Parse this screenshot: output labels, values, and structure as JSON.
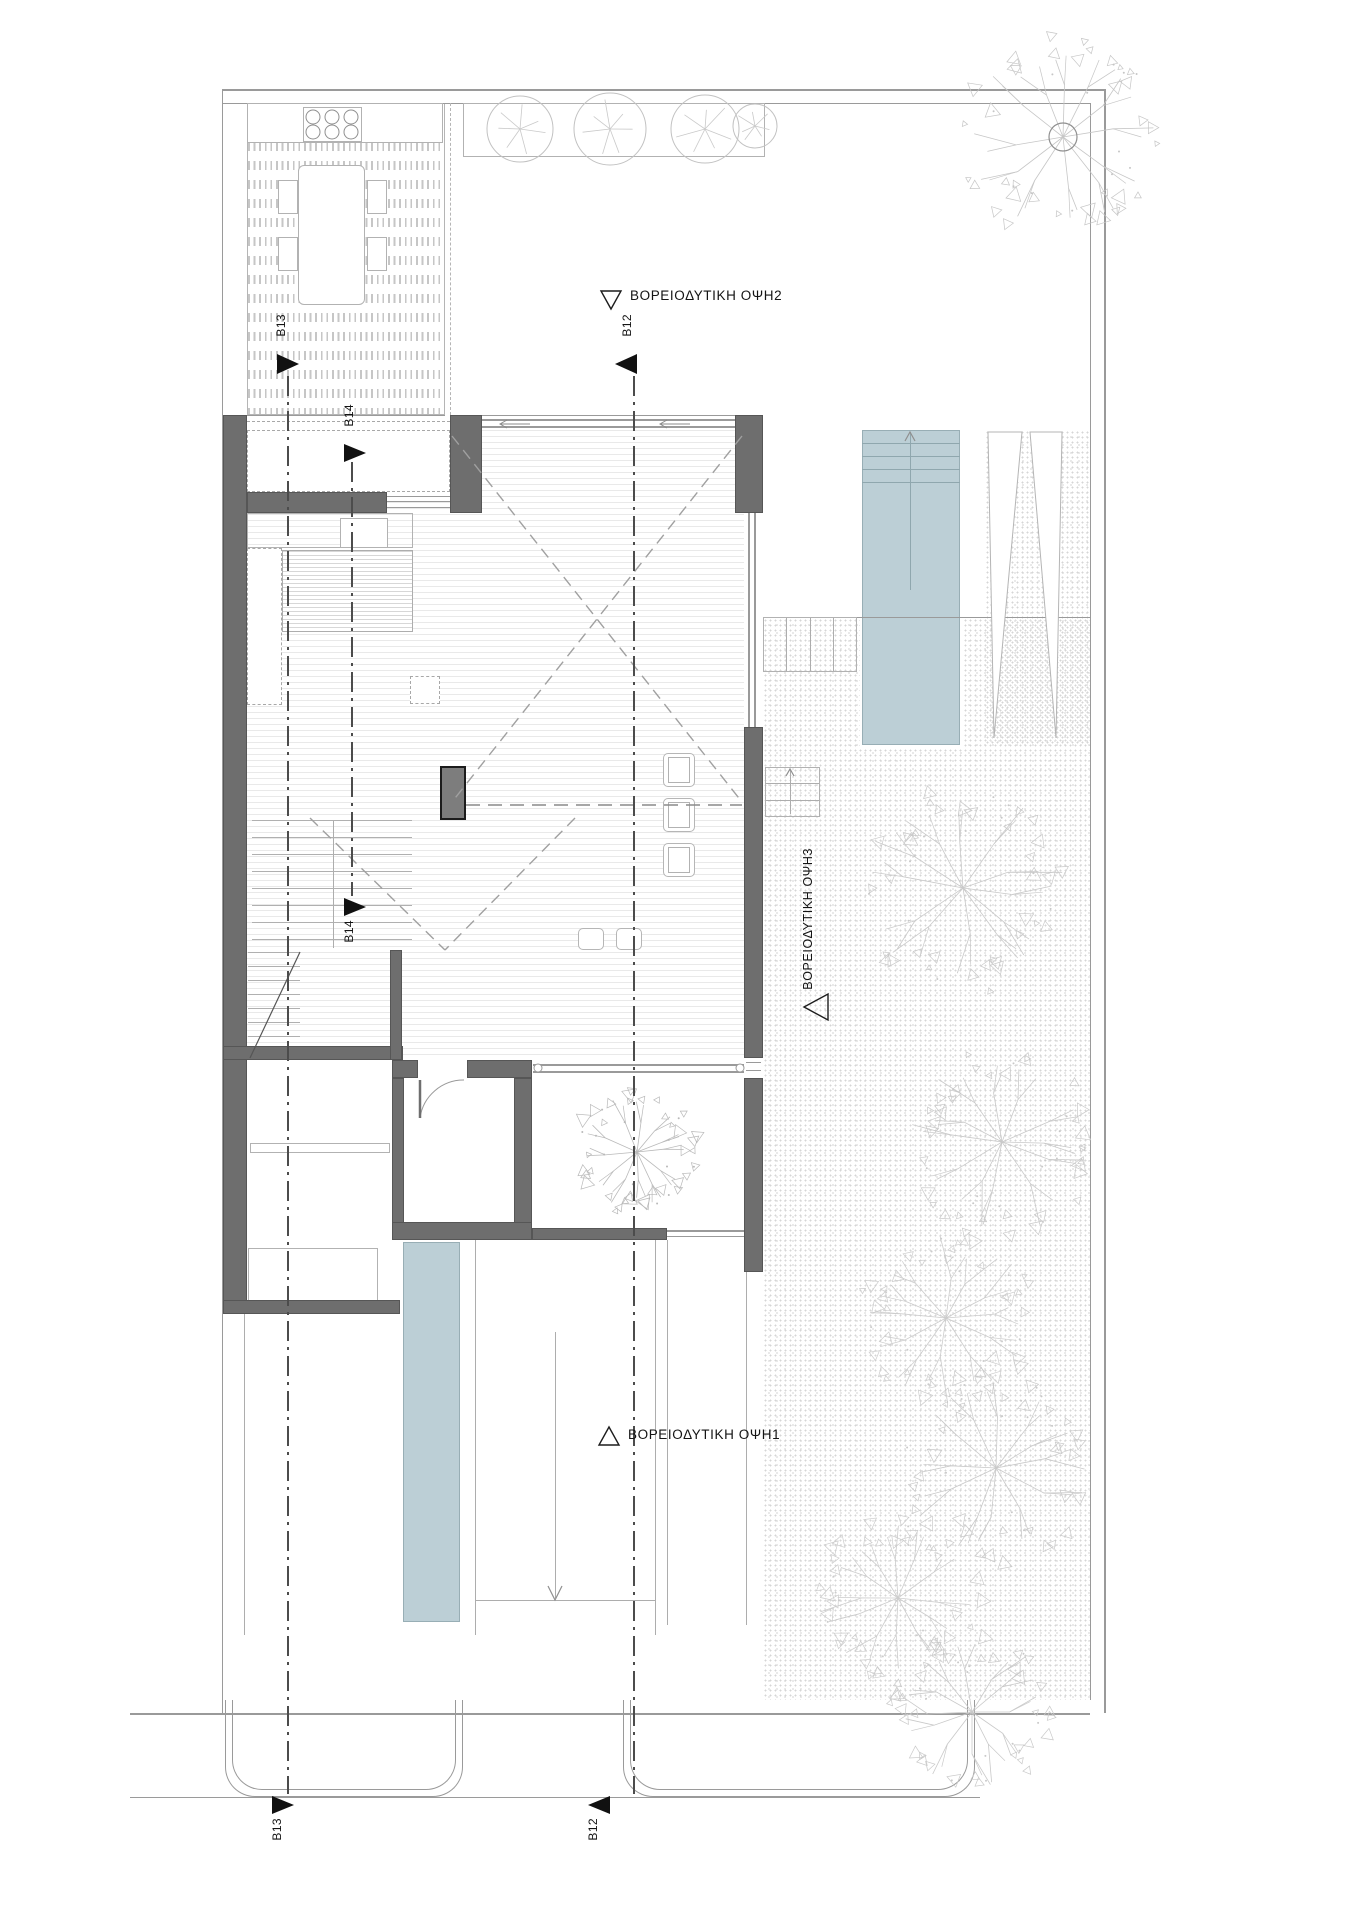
{
  "title": "Architectural ground floor site plan",
  "labels": {
    "elevation_top": "ΒΟΡΕΙΟΔΥΤΙΚΗ ΟΨΗ2",
    "elevation_bottom": "ΒΟΡΕΙΟΔΥΤΙΚΗ ΟΨΗ1",
    "elevation_right": "ΒΟΡΕΙΟΔΥΤΙΚΗ ΟΨΗ3",
    "section_b12": "B12",
    "section_b13": "B13",
    "section_b14": "B14"
  },
  "colors": {
    "wall": "#6e6e6e",
    "water": "#bccfd6",
    "line_light": "#b5b5b5",
    "line_mid": "#9a9a9a",
    "tree": "#c8c8c8",
    "marker": "#111111",
    "text": "#141414",
    "floor_line": "#e9e9e9",
    "gravel_dot": "#d6d6d6"
  },
  "scene": {
    "boundary_lines": [
      [
        222,
        89,
        883,
        2
      ],
      [
        222,
        103,
        868,
        1
      ],
      [
        1104,
        89,
        2,
        1624
      ],
      [
        1090,
        103,
        1,
        1597
      ],
      [
        222,
        89,
        1,
        1624
      ],
      [
        130,
        1713,
        960,
        2
      ],
      [
        130,
        1797,
        850,
        1
      ],
      [
        450,
        415,
        313,
        1
      ],
      [
        763,
        617,
        327,
        1
      ]
    ],
    "gravel_regions": [
      [
        763,
        618,
        327,
        1082
      ],
      [
        985,
        430,
        105,
        315
      ]
    ],
    "floor_region": [
      247,
      430,
      497,
      628
    ],
    "deck_region": [
      247,
      103,
      198,
      312
    ],
    "walls": [
      [
        223,
        415,
        24,
        887
      ],
      [
        247,
        492,
        140,
        21
      ],
      [
        450,
        415,
        32,
        98
      ],
      [
        735,
        415,
        28,
        98
      ],
      [
        744,
        727,
        19,
        331
      ],
      [
        744,
        1078,
        19,
        194
      ],
      [
        223,
        1046,
        180,
        14
      ],
      [
        392,
        1060,
        26,
        18
      ],
      [
        467,
        1060,
        65,
        18
      ],
      [
        392,
        1078,
        12,
        162
      ],
      [
        514,
        1078,
        18,
        145
      ],
      [
        392,
        1222,
        140,
        18
      ],
      [
        532,
        1228,
        135,
        12
      ],
      [
        223,
        1300,
        177,
        14
      ],
      [
        390,
        950,
        12,
        110
      ]
    ],
    "fireplace": [
      440,
      766,
      26,
      54
    ],
    "white_fills": [
      [
        404,
        1078,
        110,
        144
      ],
      [
        533,
        1075,
        211,
        153
      ],
      [
        247,
        1060,
        143,
        240
      ],
      [
        860,
        428,
        102,
        319
      ]
    ],
    "boxes": [
      {
        "r": [
          247,
          103,
          196,
          40
        ],
        "n": "outdoor-counter"
      },
      {
        "r": [
          303,
          107,
          59,
          35
        ],
        "n": "bbq-grill"
      },
      {
        "r": [
          463,
          103,
          302,
          54
        ],
        "n": "planter"
      },
      {
        "r": [
          298,
          165,
          67,
          140
        ],
        "n": "outdoor-table",
        "rad": 6
      },
      {
        "r": [
          278,
          180,
          20,
          34
        ],
        "n": "outdoor-chair"
      },
      {
        "r": [
          278,
          237,
          20,
          34
        ],
        "n": "outdoor-chair"
      },
      {
        "r": [
          367,
          180,
          20,
          34
        ],
        "n": "outdoor-chair"
      },
      {
        "r": [
          367,
          237,
          20,
          34
        ],
        "n": "outdoor-chair"
      },
      {
        "r": [
          247,
          513,
          166,
          35
        ],
        "n": "kitchen-counter",
        "nofill": true
      },
      {
        "r": [
          340,
          518,
          48,
          30
        ],
        "n": "cooktop"
      },
      {
        "r": [
          343,
          562,
          40,
          35
        ],
        "n": "sink"
      },
      {
        "r": [
          349,
          568,
          28,
          23
        ],
        "n": "sink-basin"
      },
      {
        "r": [
          250,
          1143,
          140,
          10
        ],
        "n": "shelf"
      },
      {
        "r": [
          248,
          1248,
          130,
          53
        ],
        "n": "cabinets"
      },
      {
        "r": [
          763,
          617,
          94,
          55
        ],
        "n": "garden-steps",
        "nofill": true
      },
      {
        "r": [
          765,
          767,
          55,
          50
        ],
        "n": "terrace-steps",
        "nofill": true
      }
    ],
    "dashed_boxes": [
      {
        "r": [
          247,
          430,
          203,
          62
        ],
        "n": "vestibule"
      },
      {
        "r": [
          247,
          548,
          35,
          157
        ],
        "n": "kitchen-cabinets-left"
      },
      {
        "r": [
          410,
          676,
          30,
          28
        ],
        "n": "island-appliance"
      }
    ],
    "island": [
      282,
      550,
      131,
      82
    ],
    "chairs": [
      [
        663,
        753,
        32,
        34
      ],
      [
        663,
        798,
        32,
        34
      ],
      [
        663,
        843,
        32,
        34
      ]
    ],
    "stools": [
      [
        578,
        928,
        26,
        22
      ],
      [
        616,
        928,
        26,
        22
      ]
    ],
    "glass_lines": [
      [
        482,
        419,
        253,
        2
      ],
      [
        482,
        426,
        253,
        2
      ],
      [
        748,
        513,
        2,
        214
      ],
      [
        754,
        513,
        2,
        214
      ],
      [
        533,
        1064,
        211,
        2
      ],
      [
        533,
        1071,
        211,
        2
      ],
      [
        667,
        1230,
        77,
        2
      ],
      [
        667,
        1236,
        77,
        1
      ],
      [
        247,
        415,
        198,
        1
      ],
      [
        387,
        496,
        63,
        1
      ],
      [
        387,
        501,
        63,
        1
      ],
      [
        387,
        507,
        63,
        1
      ],
      [
        746,
        1062,
        15,
        1
      ],
      [
        746,
        1070,
        15,
        1
      ]
    ],
    "detail_lines": [
      [
        475,
        1240,
        1,
        395
      ],
      [
        655,
        1240,
        1,
        395
      ],
      [
        667,
        1240,
        1,
        385
      ],
      [
        746,
        1272,
        1,
        353
      ],
      [
        475,
        1600,
        180,
        1
      ],
      [
        244,
        1314,
        1,
        321
      ],
      [
        786,
        617,
        1,
        55
      ],
      [
        810,
        617,
        1,
        55
      ],
      [
        833,
        617,
        1,
        55
      ],
      [
        765,
        783,
        55,
        1
      ],
      [
        765,
        800,
        55,
        1
      ],
      [
        248,
        1274,
        130,
        1
      ],
      [
        281,
        1248,
        1,
        53
      ],
      [
        314,
        1248,
        1,
        53
      ],
      [
        347,
        1248,
        1,
        53
      ],
      [
        333,
        820,
        1,
        128
      ],
      [
        555,
        1332,
        1,
        266
      ],
      [
        790,
        770,
        1,
        44
      ]
    ],
    "stairs": {
      "lower": {
        "x": 252,
        "w": 160,
        "y0": 820,
        "step": 17,
        "count": 8
      },
      "upper": {
        "x": 248,
        "w": 52,
        "y0": 952,
        "step": 14,
        "count": 8
      }
    },
    "pool": {
      "r": [
        862,
        430,
        98,
        315
      ],
      "steps": [
        443,
        456,
        469,
        482
      ],
      "center_x": 910,
      "line_y": [
        432,
        590
      ]
    },
    "water_channel": [
      403,
      1242,
      57,
      380
    ],
    "ramp_triangles": [
      [
        [
          988,
          432
        ],
        [
          1022,
          432
        ],
        [
          994,
          738
        ]
      ],
      [
        [
          1030,
          432
        ],
        [
          1062,
          432
        ],
        [
          1056,
          738
        ]
      ]
    ],
    "aprons": [
      [
        225,
        1700,
        238,
        97
      ],
      [
        623,
        1700,
        352,
        97
      ]
    ],
    "dashed_diagonals": [
      [
        452,
        436,
        742,
        802
      ],
      [
        742,
        436,
        452,
        802
      ],
      [
        310,
        818,
        445,
        950
      ],
      [
        575,
        818,
        445,
        950
      ]
    ],
    "long_dash_h": [
      466,
      805,
      742
    ],
    "vestibule_dash_line": [
      247,
      421,
      203
    ],
    "deck_edge_dash": [
      450,
      103,
      312
    ],
    "door_arc": {
      "hinge": [
        420,
        1080
      ],
      "leaf_end": [
        420,
        1118
      ],
      "arc_end": [
        464,
        1080
      ]
    },
    "stair_break": [
      [
        250,
        1058
      ],
      [
        300,
        952
      ]
    ],
    "slide_arrows": [
      [
        530,
        424,
        500,
        424
      ],
      [
        690,
        424,
        660,
        424
      ]
    ],
    "pool_arrow": [
      [
        905,
        441
      ],
      [
        910,
        432
      ],
      [
        915,
        441
      ]
    ],
    "walk_arrow": [
      [
        548,
        1586
      ],
      [
        555,
        1600
      ],
      [
        562,
        1586
      ]
    ],
    "steps_arrow": [
      [
        786,
        776
      ],
      [
        790,
        769
      ],
      [
        794,
        776
      ]
    ],
    "glass_end_circles": [
      [
        538,
        1068
      ],
      [
        740,
        1068
      ]
    ],
    "trunk_circle": [
      1063,
      137,
      14
    ],
    "trees": [
      {
        "x": 1063,
        "y": 137,
        "r": 98,
        "c": "#c6c6c6"
      },
      {
        "x": 963,
        "y": 888,
        "r": 102,
        "c": "#c9c9c9"
      },
      {
        "x": 1002,
        "y": 1142,
        "r": 92,
        "c": "#c9c9c9"
      },
      {
        "x": 946,
        "y": 1318,
        "r": 85,
        "c": "#cccccc"
      },
      {
        "x": 996,
        "y": 1468,
        "r": 92,
        "c": "#c9c9c9"
      },
      {
        "x": 898,
        "y": 1598,
        "r": 80,
        "c": "#cccccc"
      },
      {
        "x": 972,
        "y": 1712,
        "r": 78,
        "c": "#c9c9c9"
      },
      {
        "x": 637,
        "y": 1152,
        "r": 60,
        "c": "#b9b9b9"
      }
    ],
    "shrubs": [
      {
        "x": 520,
        "y": 129,
        "r": 33
      },
      {
        "x": 610,
        "y": 129,
        "r": 36
      },
      {
        "x": 705,
        "y": 129,
        "r": 34
      },
      {
        "x": 755,
        "y": 126,
        "r": 22
      }
    ],
    "section_lines": [
      {
        "x": 287,
        "y1": 376,
        "y2": 1794
      },
      {
        "x": 633,
        "y1": 376,
        "y2": 1794
      },
      {
        "x": 351,
        "y1": 462,
        "y2": 896
      }
    ],
    "section_markers": [
      {
        "key": "section_b13",
        "tri": [
          [
            277,
            354
          ],
          [
            277,
            374
          ],
          [
            299,
            364
          ]
        ],
        "lx": 274,
        "ly": 314
      },
      {
        "key": "section_b12",
        "tri": [
          [
            637,
            354
          ],
          [
            637,
            374
          ],
          [
            615,
            364
          ]
        ],
        "lx": 620,
        "ly": 314
      },
      {
        "key": "section_b14",
        "tri": [
          [
            344,
            444
          ],
          [
            344,
            462
          ],
          [
            366,
            453
          ]
        ],
        "lx": 342,
        "ly": 404
      },
      {
        "key": "section_b14",
        "tri": [
          [
            344,
            898
          ],
          [
            344,
            916
          ],
          [
            366,
            907
          ]
        ],
        "lx": 342,
        "ly": 920
      },
      {
        "key": "section_b13",
        "tri": [
          [
            272,
            1796
          ],
          [
            272,
            1814
          ],
          [
            294,
            1805
          ]
        ],
        "lx": 270,
        "ly": 1818
      },
      {
        "key": "section_b12",
        "tri": [
          [
            610,
            1796
          ],
          [
            610,
            1814
          ],
          [
            588,
            1805
          ]
        ],
        "lx": 586,
        "ly": 1818
      }
    ],
    "elevation_triangles": [
      [
        [
          601,
          291
        ],
        [
          621,
          291
        ],
        [
          611,
          309
        ]
      ],
      [
        [
          599,
          1445
        ],
        [
          619,
          1445
        ],
        [
          609,
          1427
        ]
      ],
      [
        [
          828,
          994
        ],
        [
          828,
          1020
        ],
        [
          804,
          1007
        ]
      ]
    ]
  }
}
